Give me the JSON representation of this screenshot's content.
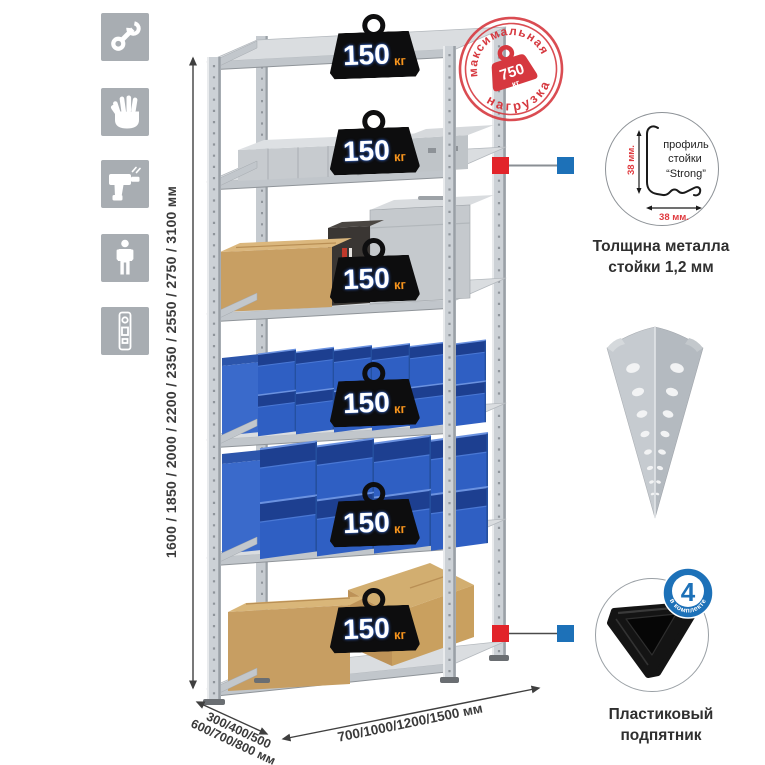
{
  "colors": {
    "accent_red": "#d6383f",
    "marker_red": "#e2242a",
    "marker_blue": "#1d71b8",
    "badge_black": "#0d0d0e",
    "unit_orange": "#f7941d",
    "bin_blue": "#2f5fc3",
    "metal_gray": "#ccd1d6",
    "icon_gray": "#a8adb2",
    "text_dark": "#3b3b3b"
  },
  "left_sidebar": {
    "icons": [
      "wrench-icon",
      "gloves-icon",
      "drill-icon",
      "person-icon",
      "level-icon"
    ]
  },
  "dimensions": {
    "height_label": "1600 / 1850 / 2000 / 2200 / 2350 / 2550 / 2750 / 3100 мм",
    "depth_label_line1": "300/400/500",
    "depth_label_line2": "600/700/800 мм",
    "width_label": "700/1000/1200/1500 мм"
  },
  "stamp": {
    "top_text": "максимальная",
    "bottom_text": "нагрузка",
    "value": "750",
    "unit": "кг"
  },
  "badges": [
    {
      "value": "150",
      "unit": "кг"
    },
    {
      "value": "150",
      "unit": "кг"
    },
    {
      "value": "150",
      "unit": "кг"
    },
    {
      "value": "150",
      "unit": "кг"
    },
    {
      "value": "150",
      "unit": "кг"
    },
    {
      "value": "150",
      "unit": "кг"
    }
  ],
  "profile": {
    "line1": "профиль",
    "line2": "стойки",
    "line3": "“Strong”",
    "dim_vertical": "38 мм.",
    "dim_horizontal": "38 мм.",
    "caption_line1": "Толщина металла",
    "caption_line2": "стойки 1,2 мм"
  },
  "foot": {
    "count": "4",
    "label": "в комплекте",
    "caption_line1": "Пластиковый",
    "caption_line2": "подпятник"
  }
}
